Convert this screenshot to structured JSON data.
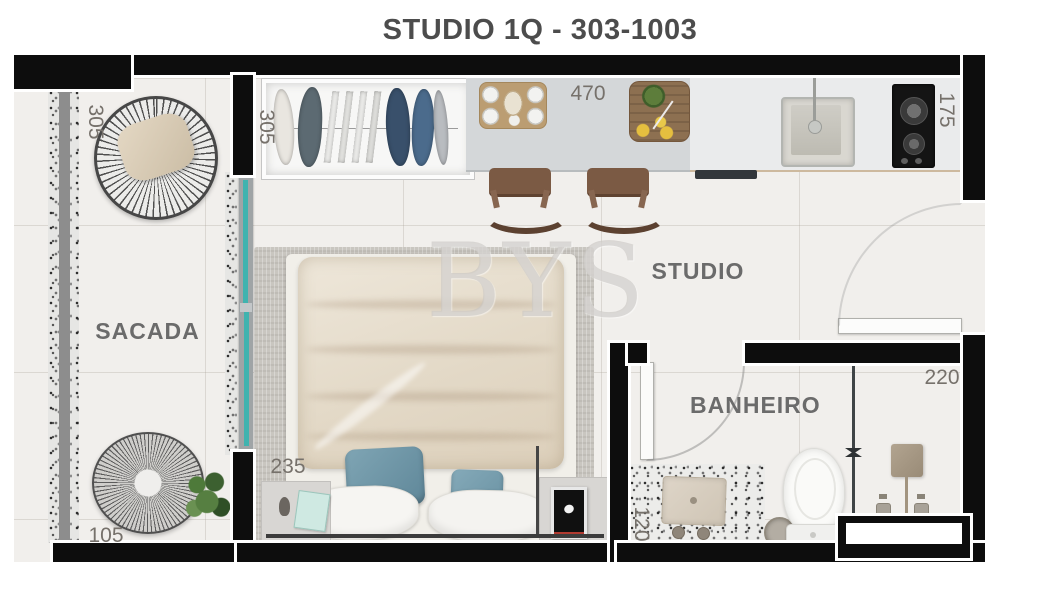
{
  "title": "STUDIO 1Q - 303-1003",
  "watermark": "BYS",
  "rooms": {
    "balcony": {
      "label": "SACADA"
    },
    "studio": {
      "label": "STUDIO"
    },
    "bathroom": {
      "label": "BANHEIRO"
    }
  },
  "dimensions": {
    "balcony_length": "305",
    "balcony_width": "105",
    "wardrobe": "305",
    "kitchen_counter": "470",
    "kitchen_depth": "175",
    "bed_wall": "235",
    "shower": "220",
    "bath_counter": "120"
  },
  "colors": {
    "wall": "#0d0d0d",
    "floor": "#f1efec",
    "label_text": "#6b6b6b",
    "dimension_text": "#76716b",
    "glass_door": "#3fb3af",
    "kitchen_counter": "#d4d7d9",
    "duvet": "#e6dcc9",
    "pillow_teal": "#6f96a7",
    "watermark": "#c8c5c1"
  }
}
